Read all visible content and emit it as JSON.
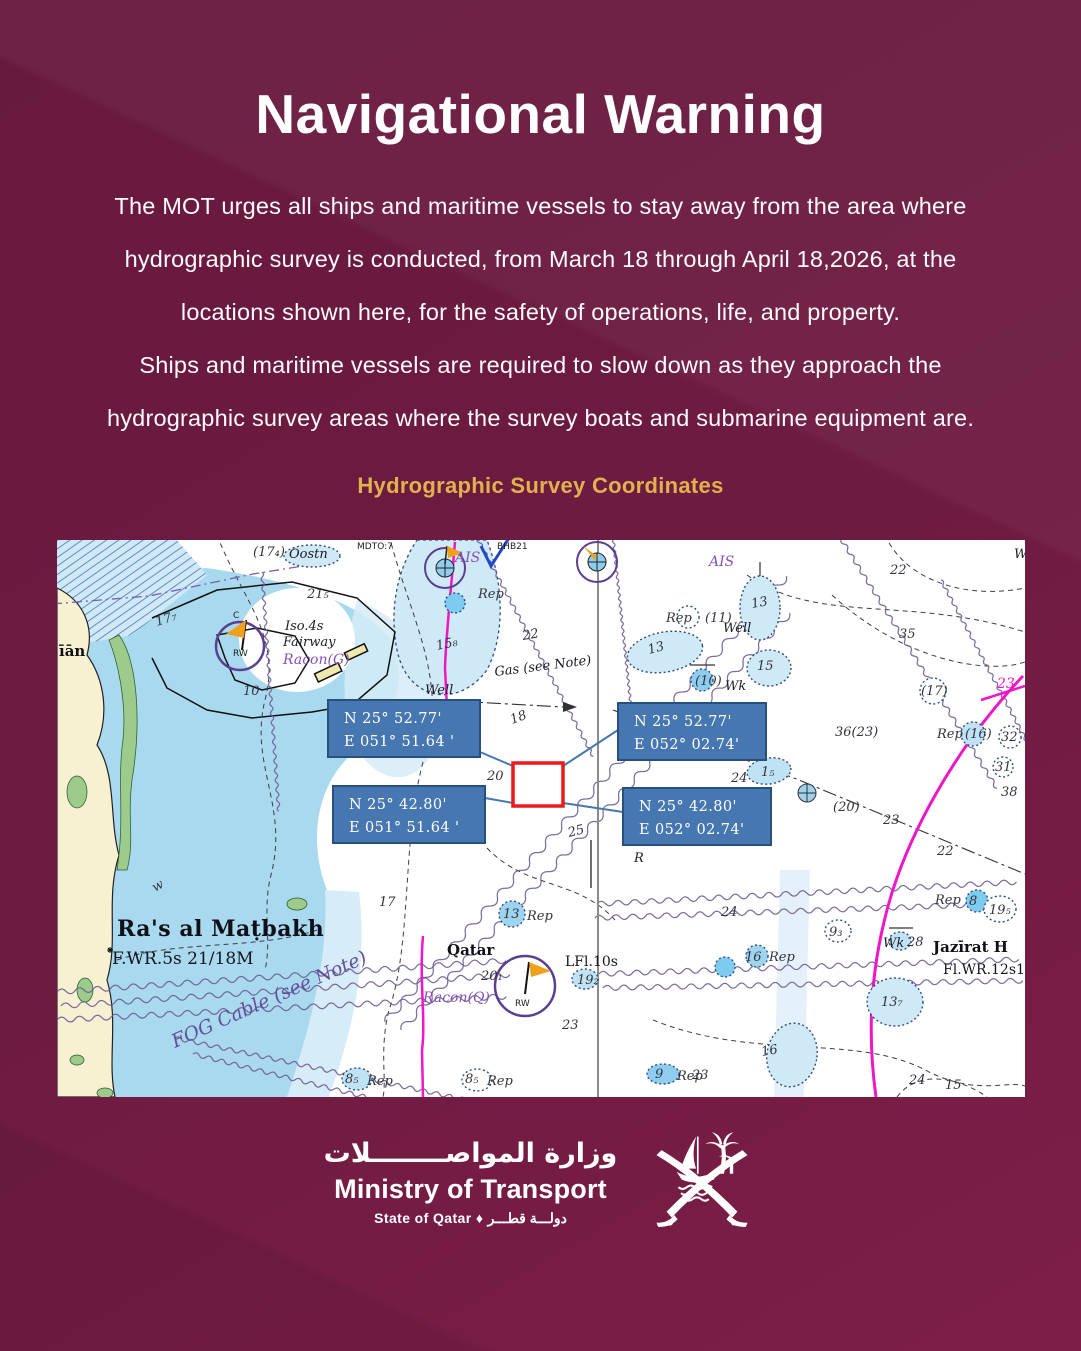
{
  "poster": {
    "title": "Navigational Warning",
    "body_lines": [
      "The MOT urges all ships and maritime vessels to stay away from the area where",
      "hydrographic survey is conducted, from March 18 through April  18,2026, at the",
      "locations shown here, for the safety of operations, life, and property.",
      "Ships and maritime vessels are required to slow down as they approach the",
      "hydrographic survey areas where the survey boats and submarine equipment are."
    ],
    "section_heading": "Hydrographic Survey Coordinates",
    "colors": {
      "background_top": "#681a3d",
      "background_bottom": "#7d1e47",
      "accent_gold": "#e2b14e",
      "text": "#ffffff"
    }
  },
  "map": {
    "description": "Nautical chart of Qatar coast showing hydrographic survey area",
    "survey_area_color": "#ec1a1a",
    "coordinate_box_color": "#4677b0",
    "coordinate_boxes": [
      {
        "corner": "north-west",
        "line1": "N 25°  52.77'",
        "line2": "E 051° 51.64 '"
      },
      {
        "corner": "north-east",
        "line1": "N 25°  52.77'",
        "line2": "E 052° 02.74'"
      },
      {
        "corner": "south-west",
        "line1": "N 25°  42.80'",
        "line2": "E 051° 51.64 '"
      },
      {
        "corner": "south-east",
        "line1": "N 25°  42.80'",
        "line2": "E 052° 02.74'"
      }
    ],
    "labels": [
      {
        "x": 100,
        "y": 86,
        "t": "17₇",
        "c": "d",
        "r": -18
      },
      {
        "x": 196,
        "y": 16,
        "t": "(17₄)",
        "c": "d"
      },
      {
        "x": 232,
        "y": 18,
        "t": "Oostn",
        "c": "b"
      },
      {
        "x": 250,
        "y": 58,
        "t": "21₅",
        "c": "d"
      },
      {
        "x": 228,
        "y": 90,
        "t": "Iso.4s",
        "c": "b"
      },
      {
        "x": 226,
        "y": 106,
        "t": "Fairway",
        "c": "b"
      },
      {
        "x": 226,
        "y": 124,
        "t": "Racon(G)",
        "c": "p"
      },
      {
        "x": 2,
        "y": 116,
        "t": "īān",
        "c": "n"
      },
      {
        "x": 186,
        "y": 155,
        "t": "10",
        "c": "d"
      },
      {
        "x": 176,
        "y": 78,
        "t": "C",
        "c": "t"
      },
      {
        "x": 176,
        "y": 116,
        "t": "RW",
        "c": "t"
      },
      {
        "x": 380,
        "y": 110,
        "t": "15₈",
        "c": "d",
        "r": -12
      },
      {
        "x": 466,
        "y": 100,
        "t": "22",
        "c": "d",
        "r": -10
      },
      {
        "x": 398,
        "y": 22,
        "t": "AIS",
        "c": "p"
      },
      {
        "x": 652,
        "y": 26,
        "t": "AIS",
        "c": "p"
      },
      {
        "x": 421,
        "y": 58,
        "t": "Rep",
        "c": "d"
      },
      {
        "x": 300,
        "y": 9,
        "t": "MDTO:7",
        "c": "t"
      },
      {
        "x": 440,
        "y": 9,
        "t": "BHB21",
        "c": "t"
      },
      {
        "x": 438,
        "y": 136,
        "t": "Gas (see Note)",
        "c": "b",
        "r": -7
      },
      {
        "x": 368,
        "y": 154,
        "t": "Well",
        "c": "b"
      },
      {
        "x": 455,
        "y": 184,
        "t": "18",
        "c": "d",
        "r": -20
      },
      {
        "x": 430,
        "y": 240,
        "t": "20",
        "c": "d"
      },
      {
        "x": 512,
        "y": 297,
        "t": "25",
        "c": "d",
        "r": -14
      },
      {
        "x": 577,
        "y": 322,
        "t": "R",
        "c": "b"
      },
      {
        "x": 609,
        "y": 82,
        "t": "Rep",
        "c": "d"
      },
      {
        "x": 648,
        "y": 82,
        "t": "(11)",
        "c": "d"
      },
      {
        "x": 695,
        "y": 68,
        "t": "13",
        "c": "d",
        "r": -10
      },
      {
        "x": 666,
        "y": 92,
        "t": "Well",
        "c": "b"
      },
      {
        "x": 592,
        "y": 114,
        "t": "13",
        "c": "d",
        "r": -15
      },
      {
        "x": 638,
        "y": 145,
        "t": "(10)",
        "c": "d"
      },
      {
        "x": 668,
        "y": 150,
        "t": "Wk",
        "c": "b"
      },
      {
        "x": 700,
        "y": 130,
        "t": "15",
        "c": "d"
      },
      {
        "x": 833,
        "y": 34,
        "t": "22",
        "c": "d"
      },
      {
        "x": 842,
        "y": 98,
        "t": "35",
        "c": "d"
      },
      {
        "x": 864,
        "y": 155,
        "t": "(17)",
        "c": "d"
      },
      {
        "x": 940,
        "y": 148,
        "t": "23",
        "c": "m"
      },
      {
        "x": 957,
        "y": 18,
        "t": "W",
        "c": "b"
      },
      {
        "x": 880,
        "y": 198,
        "t": "Rep",
        "c": "d"
      },
      {
        "x": 908,
        "y": 198,
        "t": "(16)",
        "c": "d"
      },
      {
        "x": 944,
        "y": 201,
        "t": "32",
        "c": "d"
      },
      {
        "x": 938,
        "y": 231,
        "t": "31",
        "c": "d"
      },
      {
        "x": 944,
        "y": 256,
        "t": "38",
        "c": "d"
      },
      {
        "x": 778,
        "y": 196,
        "t": "36(23)",
        "c": "d"
      },
      {
        "x": 674,
        "y": 242,
        "t": "24",
        "c": "d"
      },
      {
        "x": 704,
        "y": 236,
        "t": "1₅",
        "c": "d"
      },
      {
        "x": 776,
        "y": 271,
        "t": "(20)",
        "c": "d"
      },
      {
        "x": 826,
        "y": 284,
        "t": "23",
        "c": "d"
      },
      {
        "x": 880,
        "y": 315,
        "t": "22",
        "c": "d"
      },
      {
        "x": 664,
        "y": 376,
        "t": "24",
        "c": "d"
      },
      {
        "x": 878,
        "y": 364,
        "t": "Rep",
        "c": "d"
      },
      {
        "x": 912,
        "y": 365,
        "t": "8",
        "c": "d"
      },
      {
        "x": 932,
        "y": 374,
        "t": "19₅",
        "c": "d"
      },
      {
        "x": 772,
        "y": 396,
        "t": "9₃",
        "c": "d"
      },
      {
        "x": 826,
        "y": 407,
        "t": "Wk",
        "c": "b"
      },
      {
        "x": 850,
        "y": 406,
        "t": "28",
        "c": "d"
      },
      {
        "x": 876,
        "y": 412,
        "t": "Jazīrat  H",
        "c": "n"
      },
      {
        "x": 886,
        "y": 434,
        "t": "Fl.WR.12s19",
        "c": "l"
      },
      {
        "x": 688,
        "y": 421,
        "t": "16",
        "c": "d"
      },
      {
        "x": 712,
        "y": 421,
        "t": "Rep",
        "c": "d"
      },
      {
        "x": 824,
        "y": 466,
        "t": "13₇",
        "c": "d"
      },
      {
        "x": 705,
        "y": 516,
        "t": "16",
        "c": "d",
        "r": -10
      },
      {
        "x": 852,
        "y": 544,
        "t": "24",
        "c": "d"
      },
      {
        "x": 888,
        "y": 549,
        "t": "15",
        "c": "d"
      },
      {
        "x": 635,
        "y": 539,
        "t": "23",
        "c": "d"
      },
      {
        "x": 598,
        "y": 538,
        "t": "9",
        "c": "d"
      },
      {
        "x": 620,
        "y": 540,
        "t": "Rep",
        "c": "d"
      },
      {
        "x": 446,
        "y": 378,
        "t": "13",
        "c": "d"
      },
      {
        "x": 470,
        "y": 380,
        "t": "Rep",
        "c": "d"
      },
      {
        "x": 390,
        "y": 415,
        "t": "Qatar",
        "c": "n"
      },
      {
        "x": 508,
        "y": 426,
        "t": "LFl.10s",
        "c": "l"
      },
      {
        "x": 520,
        "y": 444,
        "t": "19₂",
        "c": "d"
      },
      {
        "x": 424,
        "y": 440,
        "t": "20₁",
        "c": "d"
      },
      {
        "x": 366,
        "y": 462,
        "t": "Racon(Q)",
        "c": "p"
      },
      {
        "x": 458,
        "y": 466,
        "t": "RW",
        "c": "t"
      },
      {
        "x": 505,
        "y": 489,
        "t": "23",
        "c": "d"
      },
      {
        "x": 288,
        "y": 543,
        "t": "8₅",
        "c": "d"
      },
      {
        "x": 310,
        "y": 545,
        "t": "Rep",
        "c": "d"
      },
      {
        "x": 408,
        "y": 543,
        "t": "8₅",
        "c": "d"
      },
      {
        "x": 430,
        "y": 545,
        "t": "Rep",
        "c": "d"
      },
      {
        "x": 60,
        "y": 396,
        "t": "Ra's al Maṭbakh",
        "c": "n2"
      },
      {
        "x": 55,
        "y": 424,
        "t": "F.WR.5s 21/18M",
        "c": "l2"
      },
      {
        "x": 118,
        "y": 508,
        "t": "FOG Cable (see Note)",
        "c": "f",
        "r": -24
      },
      {
        "x": 98,
        "y": 352,
        "t": "w",
        "c": "d",
        "r": -30
      },
      {
        "x": 322,
        "y": 366,
        "t": "17",
        "c": "d"
      }
    ]
  },
  "footer": {
    "ministry_arabic": "وزارة المواصــــــــلات",
    "ministry_english": "Ministry of Transport",
    "state_line": "State of Qatar ♦ دولـــة قطـــر"
  }
}
